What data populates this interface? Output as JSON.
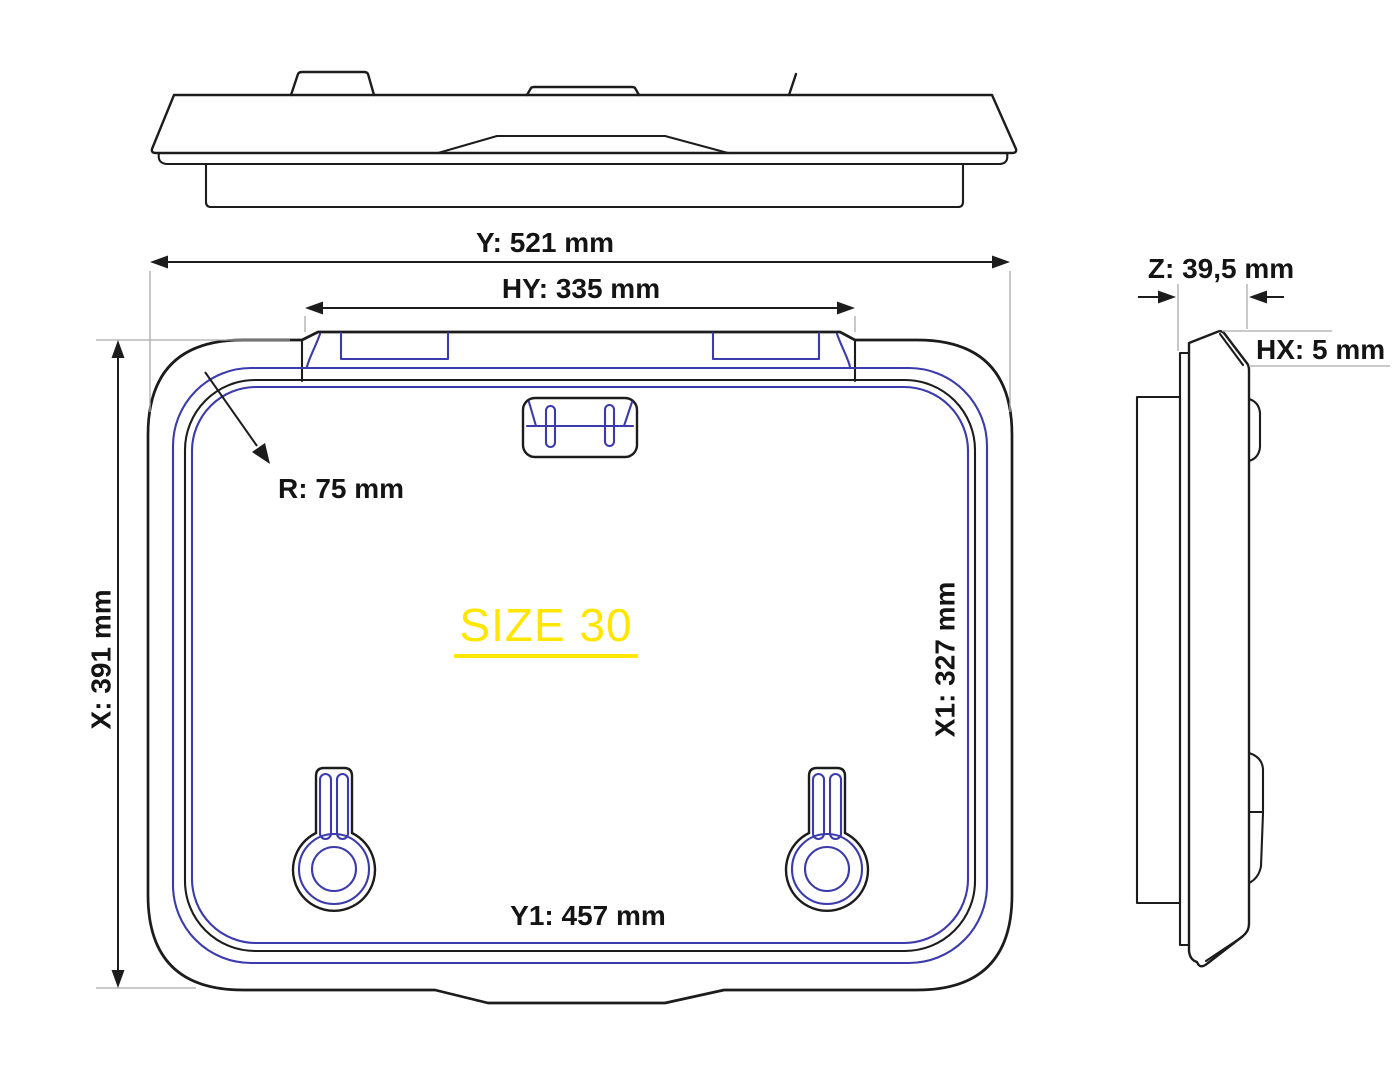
{
  "labels": {
    "y": "Y: 521 mm",
    "hy": "HY: 335 mm",
    "x": "X: 391 mm",
    "x1": "X1: 327 mm",
    "y1": "Y1: 457 mm",
    "r": "R: 75 mm",
    "z": "Z: 39,5 mm",
    "hx": "HX: 5 mm",
    "size": "SIZE 30"
  },
  "colors": {
    "outline_black": "#1c1c1c",
    "detail_blue": "#3b3bad",
    "extension_gray": "#ababab",
    "size_yellow": "#ffe600",
    "background": "#ffffff"
  }
}
